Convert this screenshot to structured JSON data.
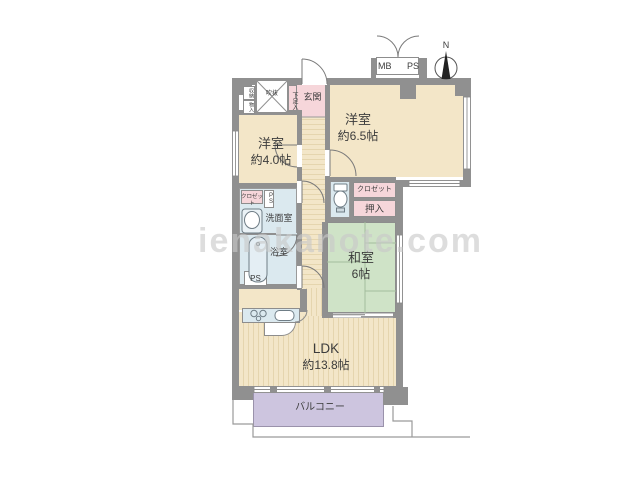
{
  "watermark": "ienakanote.com",
  "compass": {
    "north_label": "N"
  },
  "meter_box": {
    "mb_label": "MB",
    "ps_label": "PS"
  },
  "rooms": {
    "west_room_65": {
      "name": "洋室",
      "size": "約6.5帖"
    },
    "west_room_40": {
      "name": "洋室",
      "size": "約4.0帖"
    },
    "japanese_room": {
      "name": "和室",
      "size": "6帖"
    },
    "ldk": {
      "name": "LDK",
      "size": "約13.8帖"
    },
    "balcony": {
      "name": "バルコニー"
    },
    "entrance": {
      "name": "玄関"
    },
    "shoe_cabinet": {
      "name": "下足入"
    },
    "void_shaft": {
      "name": "吹抜"
    },
    "storage_upper": {
      "name": "収納"
    },
    "storage_lower": {
      "name": "物入"
    },
    "washroom": {
      "name": "洗面室"
    },
    "bathroom": {
      "name": "浴室"
    },
    "closet_west40": {
      "name": "クロゼット"
    },
    "closet_west65": {
      "name": "クロゼット"
    },
    "oshiire": {
      "name": "押入"
    },
    "pipe_space_vertical": {
      "name": "PS"
    },
    "pipe_space_box": {
      "name": "PS"
    }
  },
  "palette": {
    "wall": "#909090",
    "flooring": "#f3e6c8",
    "tatami": "#cfe3c7",
    "wet_area": "#dbe9ef",
    "closet_pink": "#f6d6da",
    "balcony_purple": "#cdc5df",
    "watermark_gray": "#c9c9c9"
  }
}
